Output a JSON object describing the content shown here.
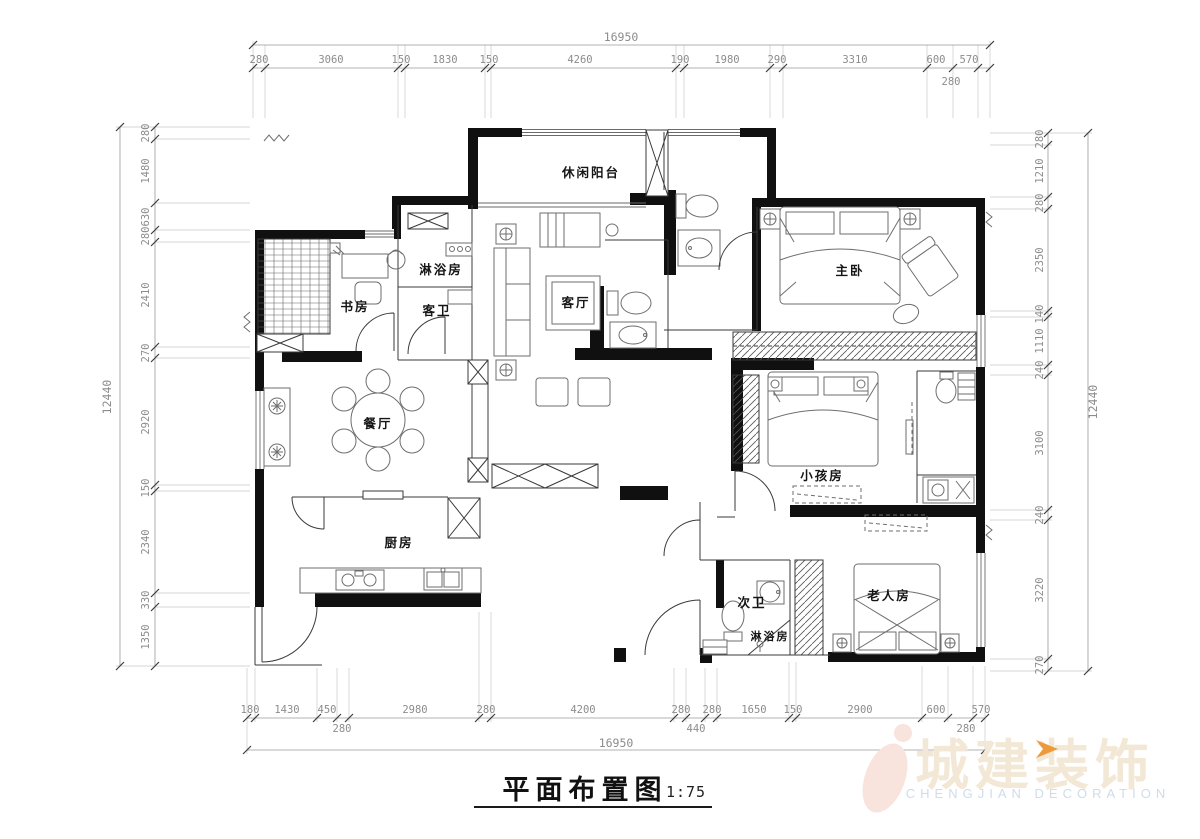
{
  "title": {
    "text": "平面布置图",
    "scale": "1:75"
  },
  "logo": {
    "name": "城建装饰",
    "sub": "CHENGJIAN DECORATION",
    "chevron_color": "#ED9A3B",
    "name_color": "#f3e7d5",
    "sub_color": "#cfdcea"
  },
  "rooms": {
    "balcony": "休闲阳台",
    "living": "客厅",
    "master": "主卧",
    "study": "书房",
    "shower_top": "淋浴房",
    "guest_bath": "客卫",
    "dining": "餐厅",
    "kitchen": "厨房",
    "kids": "小孩房",
    "second_bath": "次卫",
    "shower_bottom": "淋浴房",
    "elder": "老人房"
  },
  "dims": {
    "top": {
      "total": "16950",
      "row": [
        "280",
        "3060",
        "150",
        "1830",
        "150",
        "4260",
        "190",
        "1980",
        "290",
        "3310",
        "600",
        "570"
      ],
      "sub": "280"
    },
    "bottom": {
      "total": "16950",
      "row": [
        "180",
        "1430",
        "450",
        "2980",
        "280",
        "4200",
        "280",
        "280",
        "1650",
        "150",
        "2900",
        "600",
        "570"
      ],
      "sub": [
        "280",
        "440",
        "280"
      ]
    },
    "left": {
      "total": "12440",
      "row": [
        "280",
        "1480",
        "630",
        "280",
        "2410",
        "270",
        "2920",
        "150",
        "2340",
        "330",
        "1350"
      ]
    },
    "right": {
      "total": "12440",
      "row": [
        "280",
        "1210",
        "280",
        "2350",
        "140",
        "1110",
        "240",
        "3100",
        "240",
        "3220",
        "270"
      ]
    }
  },
  "colors": {
    "wall": "#101010",
    "dim_text": "#8c8c8c",
    "accent": "#ED9A3B"
  }
}
